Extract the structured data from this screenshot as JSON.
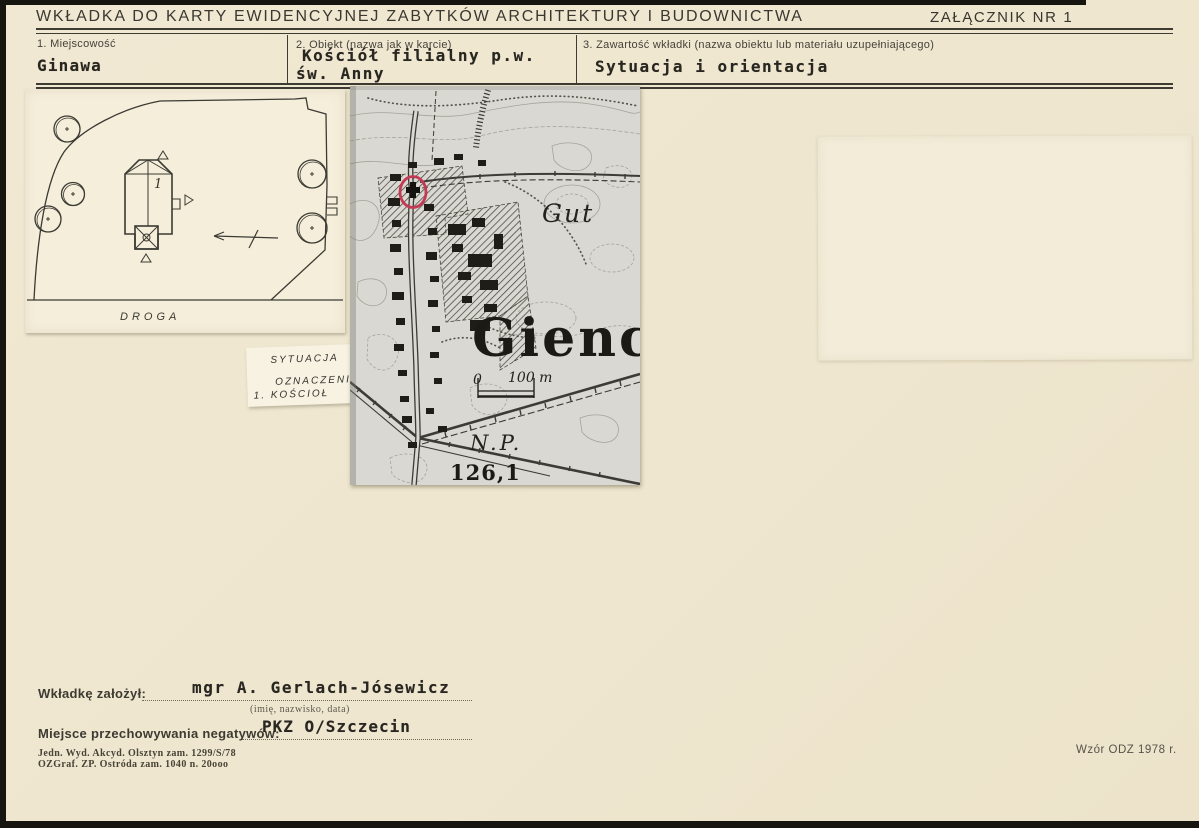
{
  "header": {
    "title": "WKŁADKA DO KARTY EWIDENCYJNEJ ZABYTKÓW ARCHITEKTURY I BUDOWNICTWA",
    "attachment": "ZAŁĄCZNIK NR 1"
  },
  "fields": [
    {
      "label": "1. Miejscowość",
      "value": "Ginawa"
    },
    {
      "label": "2. Obiekt (nazwa jak w karcie)",
      "value_line1": "Kościół filialny p.w.",
      "value_line2": "św. Anny"
    },
    {
      "label": "3. Zawartość wkładki (nazwa obiektu lub materiału uzupełniającego)",
      "value": "Sytuacja i orientacja"
    }
  ],
  "site_plan": {
    "road_label": "DROGA",
    "building_number": "1"
  },
  "legend_card": {
    "line1": "SYTUACJA",
    "line2": "OZNACZENIA",
    "line3": "1. KOŚCIOŁ"
  },
  "map": {
    "estate_label": "Gut",
    "town_label": "Gienc",
    "scale_zero": "0",
    "scale_hundred": "100 m",
    "np_label": "N.P.",
    "elevation": "126,1"
  },
  "footer": {
    "founder_label": "Wkładkę założył:",
    "founder_value": "mgr A. Gerlach-Jósewicz",
    "founder_hint": "(imię, nazwisko, data)",
    "negatives_label": "Miejsce przechowywania negatywów:",
    "negatives_value": "PKZ O/Szczecin",
    "print_line1": "Jedn. Wyd. Akcyd. Olsztyn zam. 1299/S/78",
    "print_line2": "OZGraf. ZP. Ostróda zam. 1040 n. 20ooo",
    "form_code": "Wzór ODZ 1978 r."
  },
  "colors": {
    "paper": "#efe7d0",
    "inset_paper": "#f5eeda",
    "label_paper": "#f7f2e2",
    "map_background": "#d9d8d2",
    "ink": "#3b3831",
    "red_marker": "#c43a54"
  }
}
